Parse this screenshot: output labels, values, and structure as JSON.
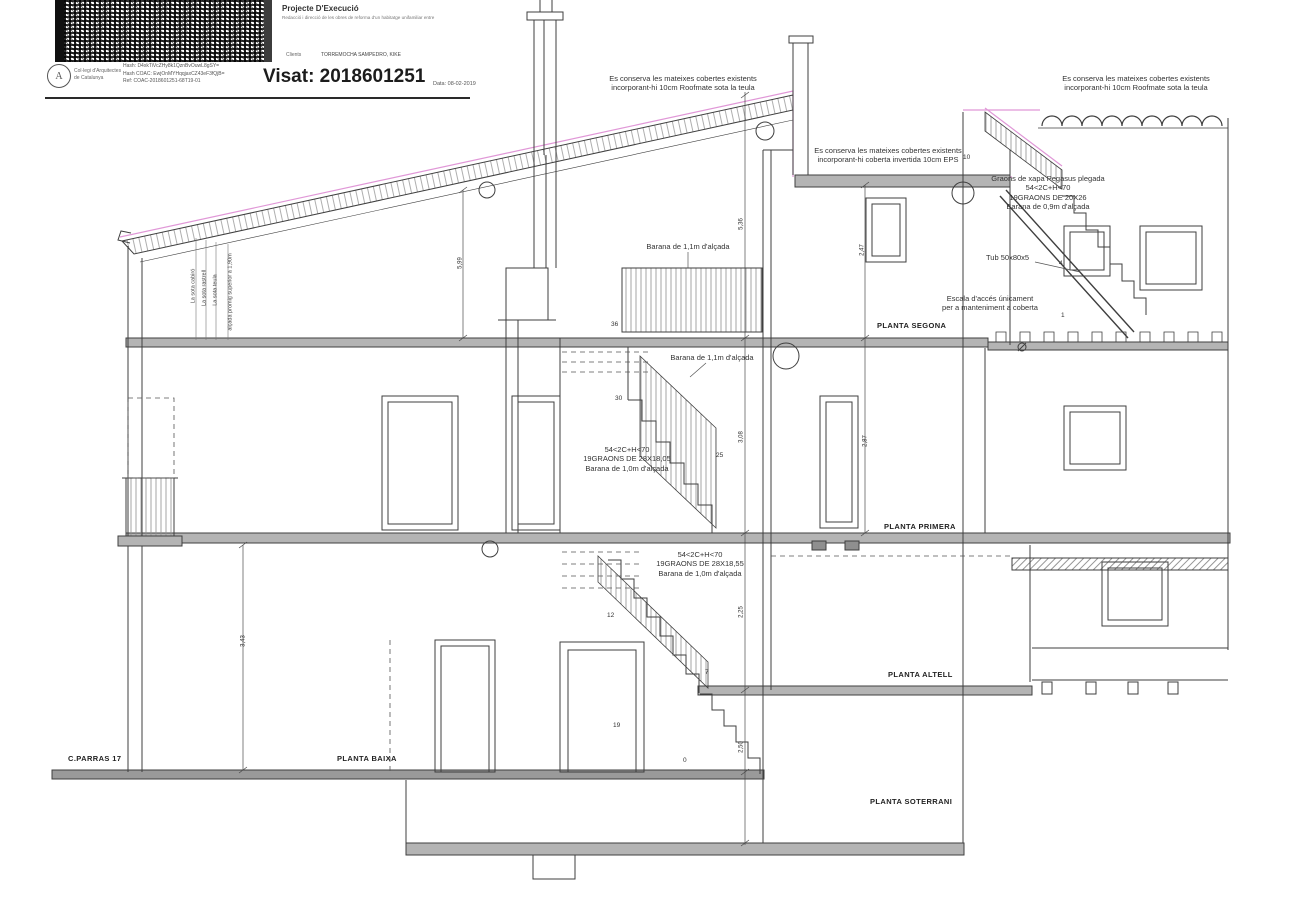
{
  "stamp": {
    "org_line1": "Col·legi d'Arquitectes",
    "org_line2": "de Catalunya",
    "hash1": "Hash: D4xkTiVcZHy8k1QznBvOuwL8gSY=",
    "hash2": "Hash COAC: EwjOnMYHqqjaxCZ43eF3fQjB=",
    "ref": "Ref: COAC-2018601251-68T19-01",
    "visat": "Visat: 2018601251",
    "date": "Data: 08-02-2019",
    "project_title": "Projecte D'Execució",
    "project_subtitle": "Redacció i direcció de les obres de reforma d'un habitatge unifamiliar entre",
    "clients_label": "Clients",
    "clients_value": "TORREMOCHA SAMPEDRO, KIKE",
    "logo_glyph": "A"
  },
  "notes": {
    "roof_left": "Es conserva les mateixes cobertes existents\nincorporant-hi 10cm Roofmate sota la teula",
    "roof_right": "Es conserva les mateixes cobertes existents\nincorporant-hi 10cm Roofmate sota la teula",
    "flat_roof": "Es conserva les mateixes cobertes existents\nincorporant-hi coberta invertida 10cm EPS",
    "roof_stair": "Graons de xapa Pegasus plegada\n54<2C+H<70\n19GRAONS DE 20X26\nBarana de 0,9m d'alçada",
    "tube": "Tub 50x80x5",
    "roof_access": "Escala d'accés únicament\nper a manteniment a coberta",
    "railing_segona": "Barana de 1,1m d'alçada",
    "railing_primera": "Barana de 1,1m d'alçada",
    "stair_upper": "54<2C+H<70\n19GRAONS DE 28X18,05\nBarana de 1,0m d'alçada",
    "stair_lower": "54<2C+H<70\n19GRAONS DE 28X18,55\nBarana de 1,0m d'alçada",
    "eave1": "La sota cabiró",
    "eave2": "La sota rastrell",
    "eave3": "La sota teula",
    "eave4": "alçada promig superior a 1,90m"
  },
  "floors": {
    "segona": "PLANTA SEGONA",
    "primera": "PLANTA PRIMERA",
    "altell": "PLANTA ALTELL",
    "baixa": "PLANTA BAIXA",
    "soterrani": "PLANTA SOTERRANI"
  },
  "street": "C.PARRAS 17",
  "steps": {
    "n36": "36",
    "n30": "30",
    "n25": "25",
    "n19": "19",
    "n12": "12",
    "n7": "7",
    "n0": "0",
    "r10": "10",
    "r4": "4",
    "r1": "1"
  },
  "dims": {
    "d536": "5,36",
    "d599": "5,99",
    "d247": "2,47",
    "d308": "3,08",
    "d287": "2,87",
    "d225": "2,25",
    "d250": "2,50",
    "d343": "3,43"
  },
  "colors": {
    "line": "#3f3f3f",
    "accent_magenta": "#d36bc6",
    "slab_gray": "#b4b4b4"
  }
}
